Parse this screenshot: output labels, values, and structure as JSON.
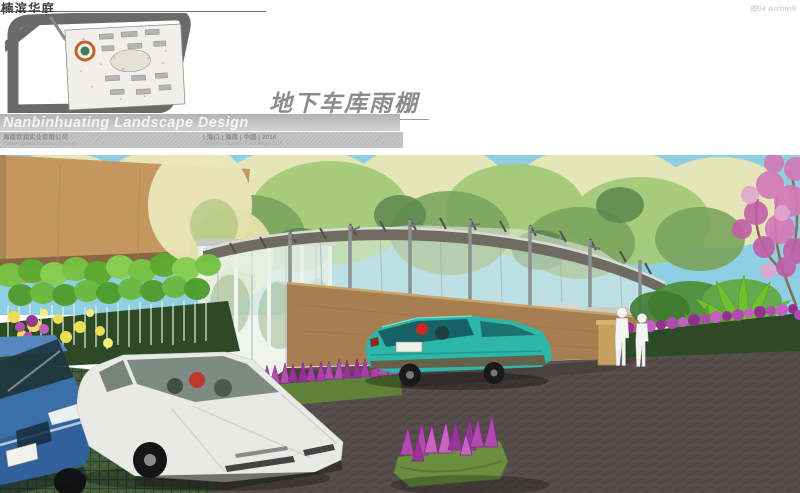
{
  "page": {
    "project_title_cn": "楠滨华庭",
    "watermark": "图04 Archteik"
  },
  "titleblock": {
    "sheet_title_cn": "地下车库雨棚",
    "design_title_en": "Nanbinhuating Landscape Design",
    "company_cn": "海南钦润实业有限公司",
    "company_en": "Hainan Qinrun Industrial Co., Ltd.",
    "location_cn": "| 海口  | 海南  | 中国  | 2016",
    "location_en": "| Haikou  | Hainan  | P.R.China  | 2016"
  },
  "site_plan": {
    "marker_ring_color": "#c0642e",
    "marker_center_color": "#3e7d5a",
    "road_color": "#6a6a6a"
  },
  "scene": {
    "colors": {
      "sky": "#8ecfe3",
      "building_tan": "#c49760",
      "canopy_roof": "#6f6b63",
      "canopy_post": "#8b9090",
      "glass": "#e3efe6",
      "ramp_wall": "#a87d50",
      "asphalt": "#564d4b",
      "grass_paver": "#415c3a",
      "car_white": "#e9e9e6",
      "car_teal": "#2cb7a8",
      "car_blue": "#3a6fa8",
      "flower_magenta": "#b04ab0",
      "flower_yellow": "#ecdf55",
      "blossom_pink": "#d27ab6",
      "foliage_pale": "#eae6b7",
      "foliage_green": "#8fbf6a",
      "hedge_dark": "#2d4a26",
      "figure": "#f4f4f2"
    }
  }
}
